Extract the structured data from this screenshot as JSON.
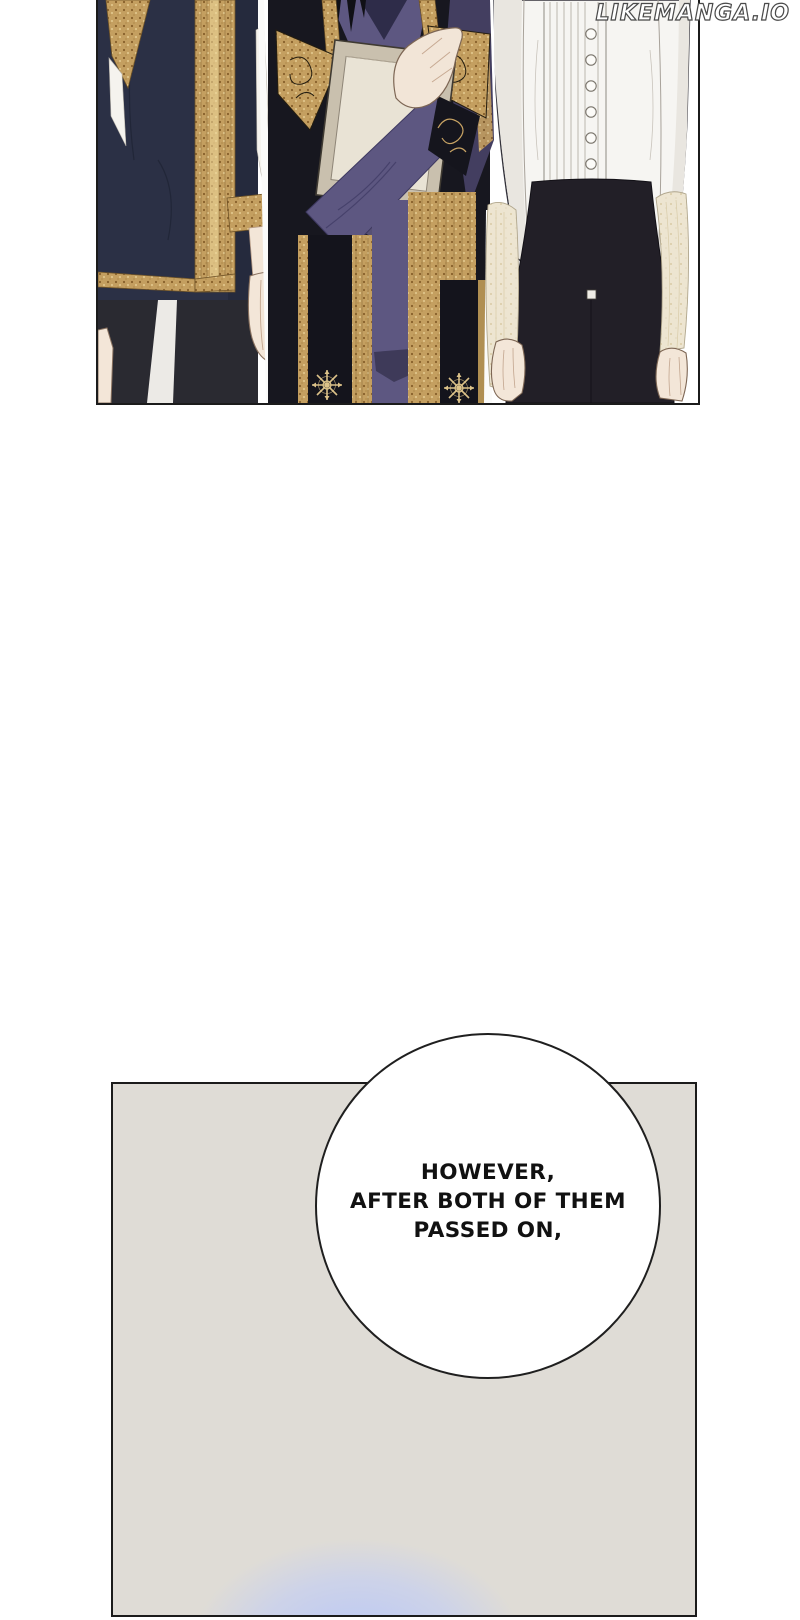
{
  "watermark": {
    "text": "LIKEMANGA.IO"
  },
  "speech_bubble": {
    "lines": [
      "HOWEVER,",
      "AFTER BOTH OF THEM",
      "PASSED ON,"
    ]
  },
  "scene": {
    "top_panel": "three standing figures in formal court clothing, cropped at neck and knees",
    "figures": [
      "man in navy coat with gold embroidered trim",
      "man in black and gold robe with purple sleeves holding a book",
      "man in white pleated dress shirt and black high-waist trousers"
    ],
    "bottom_panel": "empty grey room with blue glow at bottom"
  },
  "colors": {
    "panel_border": "#1b1b1b",
    "coat_navy": "#2b3045",
    "robe_black": "#17171f",
    "robe_purple": "#5d5781",
    "gold_trim": "#c49f60",
    "book_beige": "#c9c0ae",
    "book_page": "#e9e3d5",
    "shirt_white": "#f6f5f2",
    "pants_black": "#221f27",
    "skin": "#f3e6d8",
    "panel_gray": "#dfdcd6",
    "glow_blue": "#b7c6f8",
    "bubble_bg": "#ffffff",
    "text_black": "#111111"
  }
}
